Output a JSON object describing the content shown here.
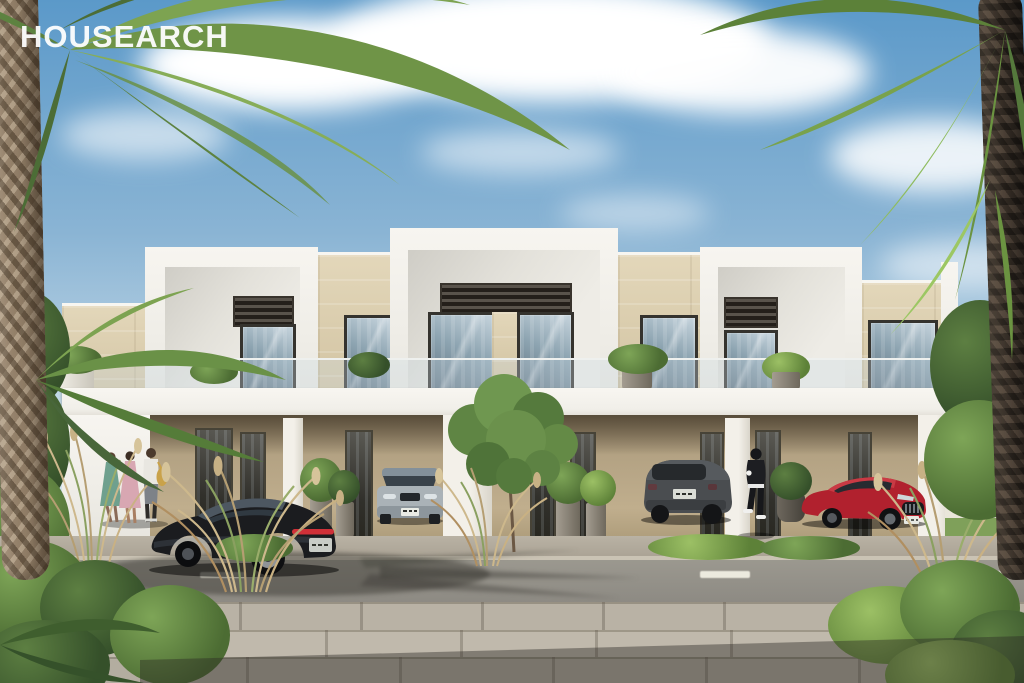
{
  "watermark": {
    "logo_text": "HOUSEARCH"
  },
  "scene": {
    "setting": "Sunny 3D render of a row of modern two-storey beige-and-white townhouses with covered carports, palm trees framing the view and a landscaped street in the foreground",
    "css_vars": {
      "sky-top": "#5b99c9",
      "sky-mid": "#8ab4d4",
      "sky-horizon": "#c9dde9",
      "stone": "#d8caaa",
      "frame-dark": "#35332e",
      "lane-mark": "#eceade",
      "sidewalk": "#b9b2a5"
    },
    "objects": {
      "vehicles": [
        {
          "name": "black-sports-coupe",
          "color": "#1b1c1f",
          "location": "street, left, rear three-quarter view"
        },
        {
          "name": "silver-compact-suv",
          "color": "#a9b1b6",
          "location": "left carport, front view"
        },
        {
          "name": "dark-grey-suv",
          "color": "#47494c",
          "location": "centre carport, rear view"
        },
        {
          "name": "red-sports-sedan",
          "color": "#b1212e",
          "location": "right carport, front three-quarter view"
        }
      ],
      "people": [
        {
          "name": "woman-in-teal-dress",
          "location": "left walkway"
        },
        {
          "name": "woman-in-pink-dress",
          "location": "left walkway"
        },
        {
          "name": "man-in-white-shirt-with-bag",
          "location": "left walkway"
        },
        {
          "name": "person-in-black-sportswear",
          "location": "centre walkway, walking"
        }
      ],
      "vegetation": [
        "palm-tree-left",
        "palm-tree-right",
        "courtyard-tree",
        "ornamental-wheat-grasses",
        "green-shrubs",
        "balcony-planters"
      ],
      "architecture": [
        "white-parapet-volumes",
        "limestone-cladding",
        "dark-slatted-louvre-panels",
        "glass-balustrades",
        "covered-carports",
        "full-height-glazing"
      ],
      "street": [
        "asphalt-road-with-dashed-lane-marking",
        "paved-sidewalk",
        "palm-shadow-on-road"
      ]
    }
  }
}
